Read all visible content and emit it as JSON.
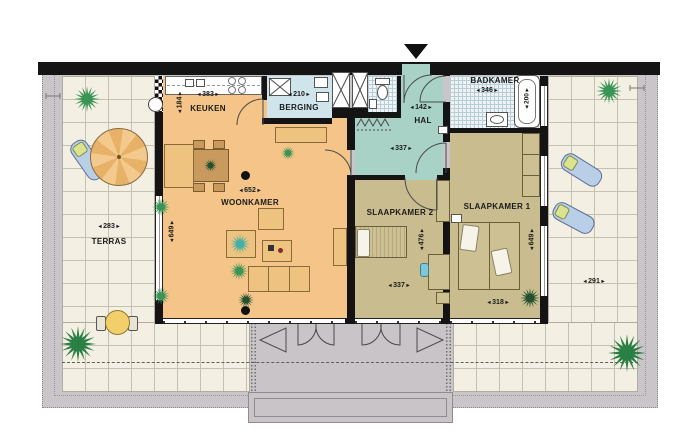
{
  "plan_type": "apartment-floorplan",
  "rooms": {
    "keuken": {
      "name": "KEUKEN",
      "width_cm": "383",
      "depth_cm": "184"
    },
    "berging": {
      "name": "BERGING",
      "width_cm": "210"
    },
    "hal": {
      "name": "HAL",
      "width_cm": "142",
      "lower_width_cm": "337"
    },
    "badkamer": {
      "name": "BADKAMER",
      "width_cm": "346",
      "bath_length_cm": "200"
    },
    "woonkamer": {
      "name": "WOONKAMER",
      "width_cm": "652",
      "depth_cm": "649"
    },
    "slaapkamer2": {
      "name": "SLAAPKAMER 2",
      "width_cm": "337",
      "depth_cm": "476"
    },
    "slaapkamer1": {
      "name": "SLAAPKAMER 1",
      "width_cm": "318",
      "depth_cm": "649"
    },
    "terras": {
      "name": "TERRAS",
      "width_left_cm": "283",
      "width_right_cm": "291"
    }
  },
  "colors": {
    "living_floor": "#f4c489",
    "bedroom_floor": "#c9bd8f",
    "hall_floor": "#a8d2c5",
    "storage_floor": "#cfe4eb",
    "terrace_tile": "#f3efe2",
    "balcony_gray": "#c9c4c7",
    "wall": "#141414",
    "plant_green": "#3a9455"
  }
}
